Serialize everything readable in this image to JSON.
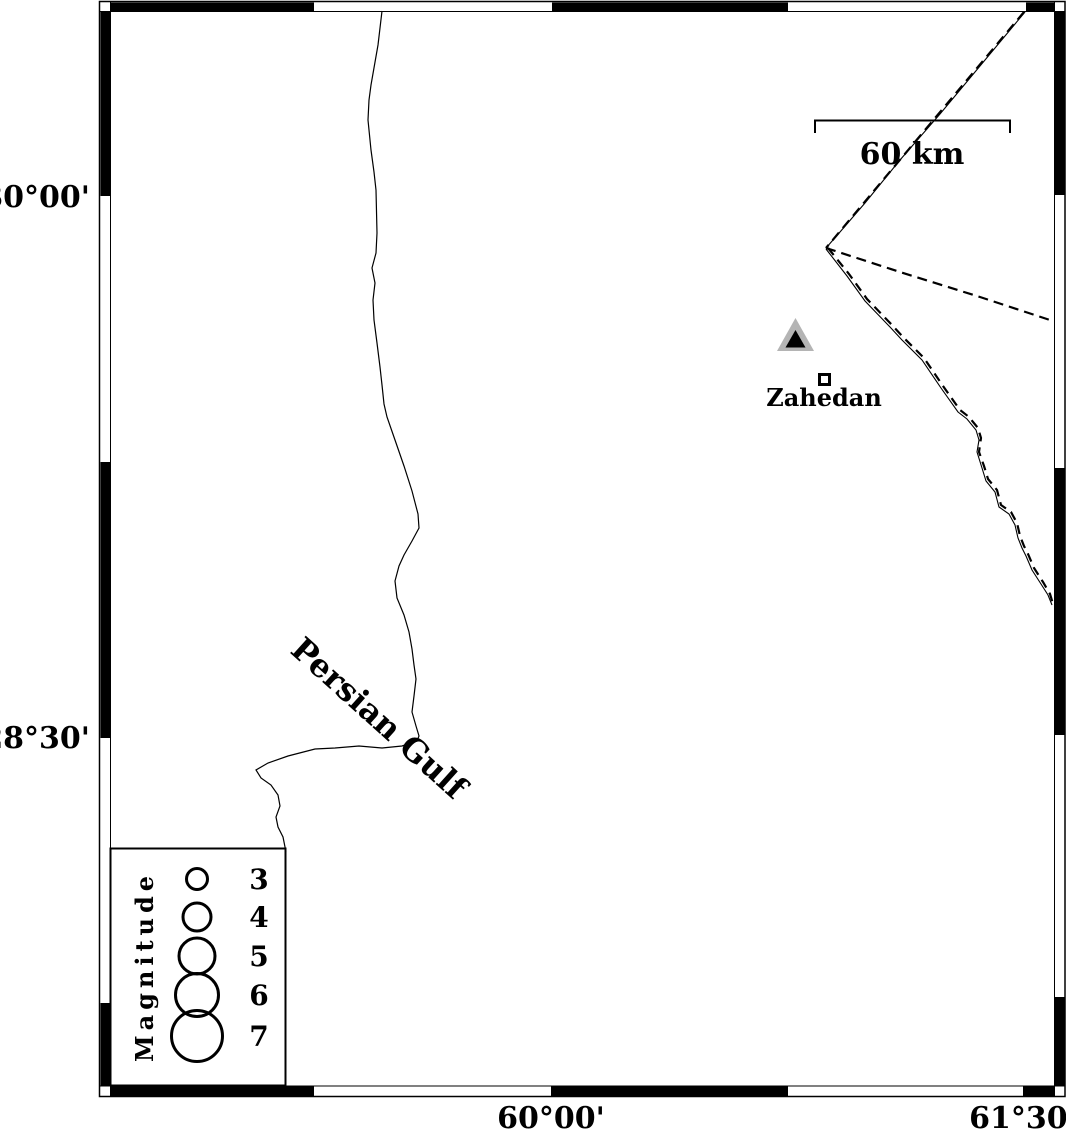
{
  "figure": {
    "kind": "seismicity-station-map",
    "background_color": "#ffffff",
    "ink_color": "#000000",
    "station_triangle_fill": "#b4b4b4"
  },
  "axes": {
    "left": [
      {
        "label": "30°00'"
      },
      {
        "label": "28°30'"
      }
    ],
    "bottom": [
      {
        "label": "60°00'"
      },
      {
        "label": "61°30'"
      }
    ]
  },
  "scale_bar": {
    "label": "60 km"
  },
  "labels": {
    "gulf": "Persian Gulf",
    "city": "Zahedan"
  },
  "legend": {
    "title": "Magnitude",
    "entries": [
      {
        "value": "3"
      },
      {
        "value": "4"
      },
      {
        "value": "5"
      },
      {
        "value": "6"
      },
      {
        "value": "7"
      }
    ]
  }
}
